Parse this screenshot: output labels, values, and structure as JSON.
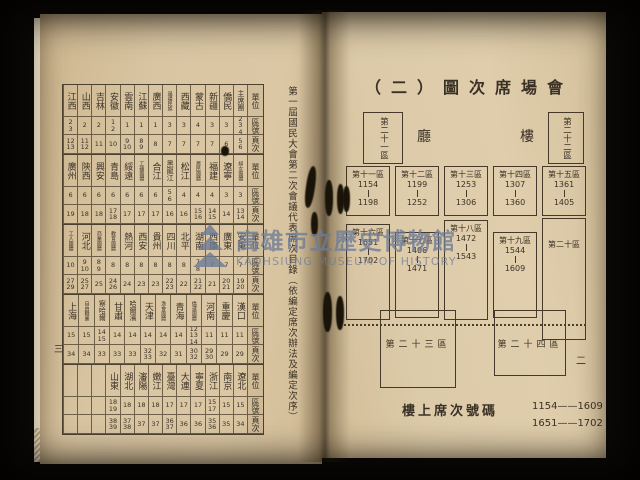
{
  "watermark": {
    "cn": "高雄市立歷史博物館",
    "en": "KAOHSIUNG MUSEUM OF HISTORY"
  },
  "colors": {
    "paper": "#d9c5a2",
    "ink": "#3a3126",
    "watermark": "#6e7c98"
  },
  "left_page": {
    "page_number": "三",
    "side_caption": "第一屆國民大會第二次會議代表席次目錄（依編定席次辦法及編定次序）",
    "table": {
      "row_headers": [
        "單位",
        "區號",
        "頁次"
      ],
      "bands": [
        {
          "units": [
            "江西",
            "山西",
            "吉林",
            "安徽",
            "雲南",
            "江蘇",
            "廣西",
            "邊疆民族",
            "西藏",
            "蒙古",
            "新疆",
            "僑民",
            "主席團"
          ],
          "qu": [
            "2\n3",
            "2",
            "2",
            "1\n2",
            "1",
            "1",
            "1",
            "3",
            "3",
            "4",
            "3",
            "3",
            "2\n3\n4"
          ],
          "ye": [
            "12\n13",
            "11\n12",
            "11",
            "10",
            "9\n10",
            "8\n9",
            "8",
            "7",
            "7",
            "7",
            "7",
            "6",
            "5\n6"
          ]
        },
        {
          "units": [
            "廣州",
            "陝西",
            "興安",
            "青島",
            "綏遠",
            "工礦團體",
            "合江",
            "黑龍江",
            "松江",
            "農民團體",
            "福建",
            "遼寧",
            "婦女團體"
          ],
          "qu": [
            "6",
            "6",
            "6",
            "6",
            "6",
            "6",
            "6",
            "5\n6",
            "4",
            "4",
            "4",
            "3",
            "3"
          ],
          "ye": [
            "19",
            "18",
            "18",
            "17\n18",
            "17",
            "17",
            "17",
            "16",
            "16",
            "15\n16",
            "14\n15",
            "14",
            "13\n14"
          ]
        },
        {
          "units": [
            "工人團體",
            "河北",
            "商業團體",
            "教育團體",
            "熱河",
            "西安",
            "貴州",
            "四川",
            "北平",
            "湖南",
            "西康",
            "廣東",
            "安東"
          ],
          "qu": [
            "10",
            "9\n10",
            "8\n9",
            "8",
            "8",
            "8",
            "8",
            "8",
            "8",
            "7\n8",
            "7",
            "7",
            "7"
          ],
          "ye": [
            "27\n29",
            "25\n27",
            "25",
            "24\n26",
            "24",
            "23",
            "23",
            "22\n23",
            "22",
            "21\n22",
            "21",
            "20\n21",
            "19\n20"
          ]
        },
        {
          "units": [
            "上海",
            "自由職業",
            "察哈爾",
            "甘肅",
            "哈爾濱",
            "天津",
            "漁會團體",
            "青海",
            "僑選團體",
            "河南",
            "重慶",
            "漢口"
          ],
          "qu": [
            "15",
            "15",
            "14\n15",
            "14",
            "14",
            "14",
            "14",
            "14",
            "12\n13\n14",
            "11",
            "11",
            "11"
          ],
          "ye": [
            "34",
            "34",
            "33",
            "33",
            "33",
            "32\n33",
            "32",
            "31",
            "30\n32",
            "29\n30",
            "29",
            "29"
          ]
        },
        {
          "units": [
            "",
            "",
            "",
            "山東",
            "湖北",
            "瀋陽",
            "嫩江",
            "臺灣",
            "大連",
            "寧夏",
            "浙江",
            "南京",
            "遼北"
          ],
          "qu": [
            "",
            "",
            "",
            "18\n19",
            "18",
            "18",
            "18",
            "17",
            "17",
            "17",
            "15\n17",
            "15",
            "15"
          ],
          "ye": [
            "",
            "",
            "",
            "38\n39",
            "37\n38",
            "37",
            "37",
            "36\n37",
            "36",
            "36",
            "35\n36",
            "35",
            "34"
          ]
        }
      ]
    }
  },
  "right_page": {
    "page_number": "二",
    "title": "（二）圖次席場會",
    "hall_label_left": "廳",
    "hall_label_right": "樓",
    "top_left_box": "第二十一區",
    "top_right_box": "第二十二區",
    "row1": [
      {
        "name": "第十一區",
        "from": "1154",
        "to": "1198"
      },
      {
        "name": "第十二區",
        "from": "1199",
        "to": "1252"
      },
      {
        "name": "第十三區",
        "from": "1253",
        "to": "1306"
      },
      {
        "name": "第十四區",
        "from": "1307",
        "to": "1360"
      },
      {
        "name": "第十五區",
        "from": "1361",
        "to": "1405"
      }
    ],
    "row2": [
      {
        "name": "第十六區",
        "from": "1651",
        "to": "1702"
      },
      {
        "name": "第十七區",
        "from": "1406",
        "to": "1471"
      },
      {
        "name": "第十八區",
        "from": "1472",
        "to": "1543"
      },
      {
        "name": "第十九區",
        "from": "1544",
        "to": "1609"
      },
      {
        "name": "第二十區",
        "from": "",
        "to": ""
      }
    ],
    "bottom_left_box": "第二十三區",
    "bottom_right_box": "第二十四區",
    "footer_caption": "樓上席次號碼",
    "footer_ranges": [
      "1154——1609",
      "1651——1702"
    ]
  }
}
